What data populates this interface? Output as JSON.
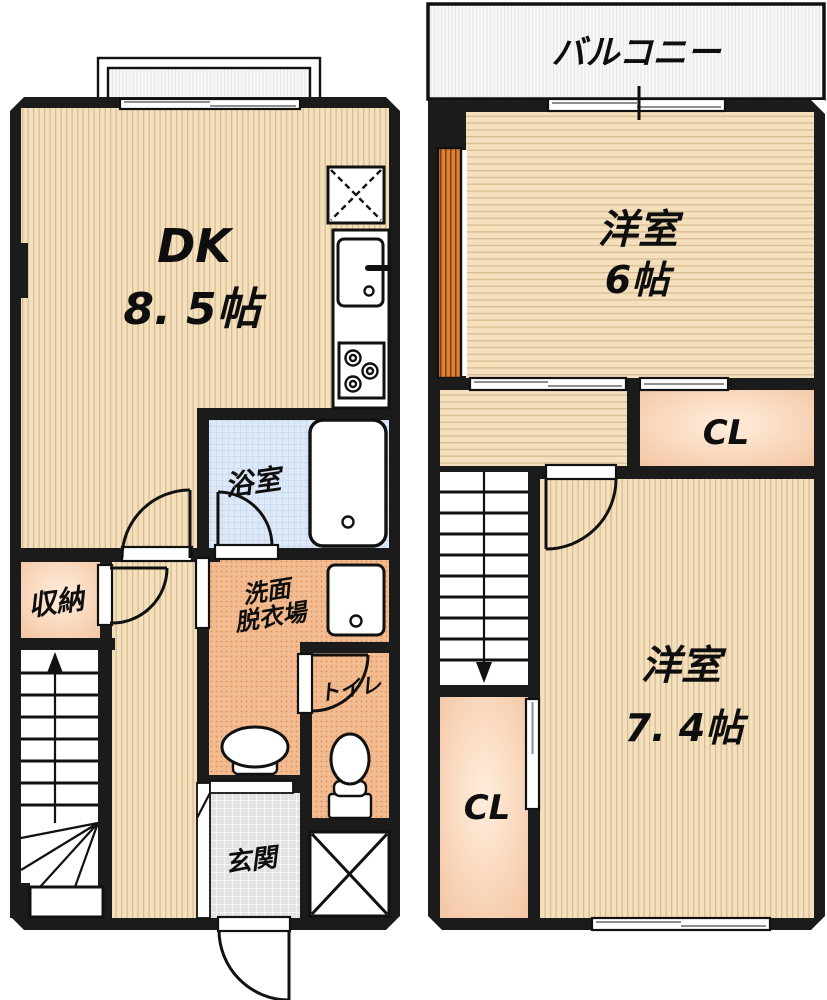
{
  "floor1": {
    "rooms": {
      "dk": {
        "name": "DK",
        "size": "8. 5帖"
      },
      "bath": {
        "name": "浴室"
      },
      "washroom": {
        "name_line1": "洗面",
        "name_line2": "脱衣場"
      },
      "toilet": {
        "name": "トイレ"
      },
      "entrance": {
        "name": "玄関"
      },
      "storage": {
        "name": "収納"
      }
    }
  },
  "floor2": {
    "rooms": {
      "balcony": {
        "name": "バルコニー"
      },
      "western_room_6": {
        "name": "洋室",
        "size": "6帖"
      },
      "closet_upper": {
        "name": "CL"
      },
      "western_room_7_4": {
        "name": "洋室",
        "size": "7. 4帖"
      },
      "closet_lower": {
        "name": "CL"
      }
    }
  },
  "fixtures": [
    "refrigerator-space",
    "kitchen-sink",
    "gas-stove",
    "bathtub",
    "washing-machine",
    "wash-basin",
    "toilet",
    "shoe-cabinet",
    "staircase-up",
    "staircase-down",
    "door-swing",
    "sliding-window"
  ],
  "colors": {
    "wall": "#1b1b1b",
    "flooring_beige": "#f4e0bd",
    "flooring_stripe": "#d9bd92",
    "bath_blue": "#dee9f8",
    "washroom_orange": "#f3bb90",
    "closet_peach": "#f6caa4",
    "entrance_gray": "#e2e2e2",
    "balcony_white": "#f7f7f7",
    "accent_orange": "#dd8134"
  }
}
